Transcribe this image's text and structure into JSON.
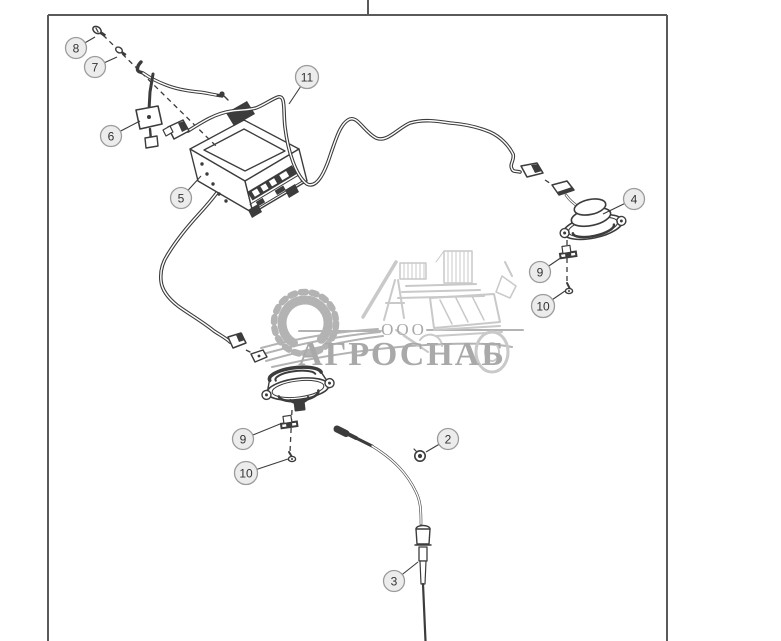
{
  "diagram": {
    "type": "exploded-parts-diagram",
    "description_visible_text_only": true
  },
  "watermark": {
    "org_form": "ООО",
    "name": "АГРОСНАБ"
  },
  "callouts": [
    {
      "id": "8",
      "label": "8",
      "cx": 76,
      "cy": 48,
      "lx": 95,
      "ly": 37
    },
    {
      "id": "7",
      "label": "7",
      "cx": 95,
      "cy": 67,
      "lx": 117,
      "ly": 57
    },
    {
      "id": "6",
      "label": "6",
      "cx": 111,
      "cy": 136,
      "lx": 140,
      "ly": 121
    },
    {
      "id": "5",
      "label": "5",
      "cx": 181,
      "cy": 198,
      "lx": 201,
      "ly": 176
    },
    {
      "id": "11",
      "label": "11",
      "cx": 307,
      "cy": 77,
      "lx": 289,
      "ly": 104
    },
    {
      "id": "4",
      "label": "4",
      "cx": 634,
      "cy": 199,
      "lx": 603,
      "ly": 214
    },
    {
      "id": "9-right",
      "label": "9",
      "cx": 540,
      "cy": 272,
      "lx": 562,
      "ly": 257
    },
    {
      "id": "10-right",
      "label": "10",
      "cx": 543,
      "cy": 306,
      "lx": 565,
      "ly": 291
    },
    {
      "id": "9-left",
      "label": "9",
      "cx": 243,
      "cy": 439,
      "lx": 280,
      "ly": 424
    },
    {
      "id": "10-left",
      "label": "10",
      "cx": 246,
      "cy": 473,
      "lx": 288,
      "ly": 459
    },
    {
      "id": "2",
      "label": "2",
      "cx": 448,
      "cy": 439,
      "lx": 426,
      "ly": 452
    },
    {
      "id": "3",
      "label": "3",
      "cx": 394,
      "cy": 581,
      "lx": 418,
      "ly": 562
    }
  ],
  "colors": {
    "line": "#3c3c3c",
    "frame": "#5a5a5a",
    "callout_fill": "#ececec",
    "callout_stroke": "#9b9b9b",
    "callout_text": "#333333",
    "wm": "#b3b3b3",
    "wm_light": "#c9c9c9",
    "wm_text": "#a9a9a9"
  }
}
